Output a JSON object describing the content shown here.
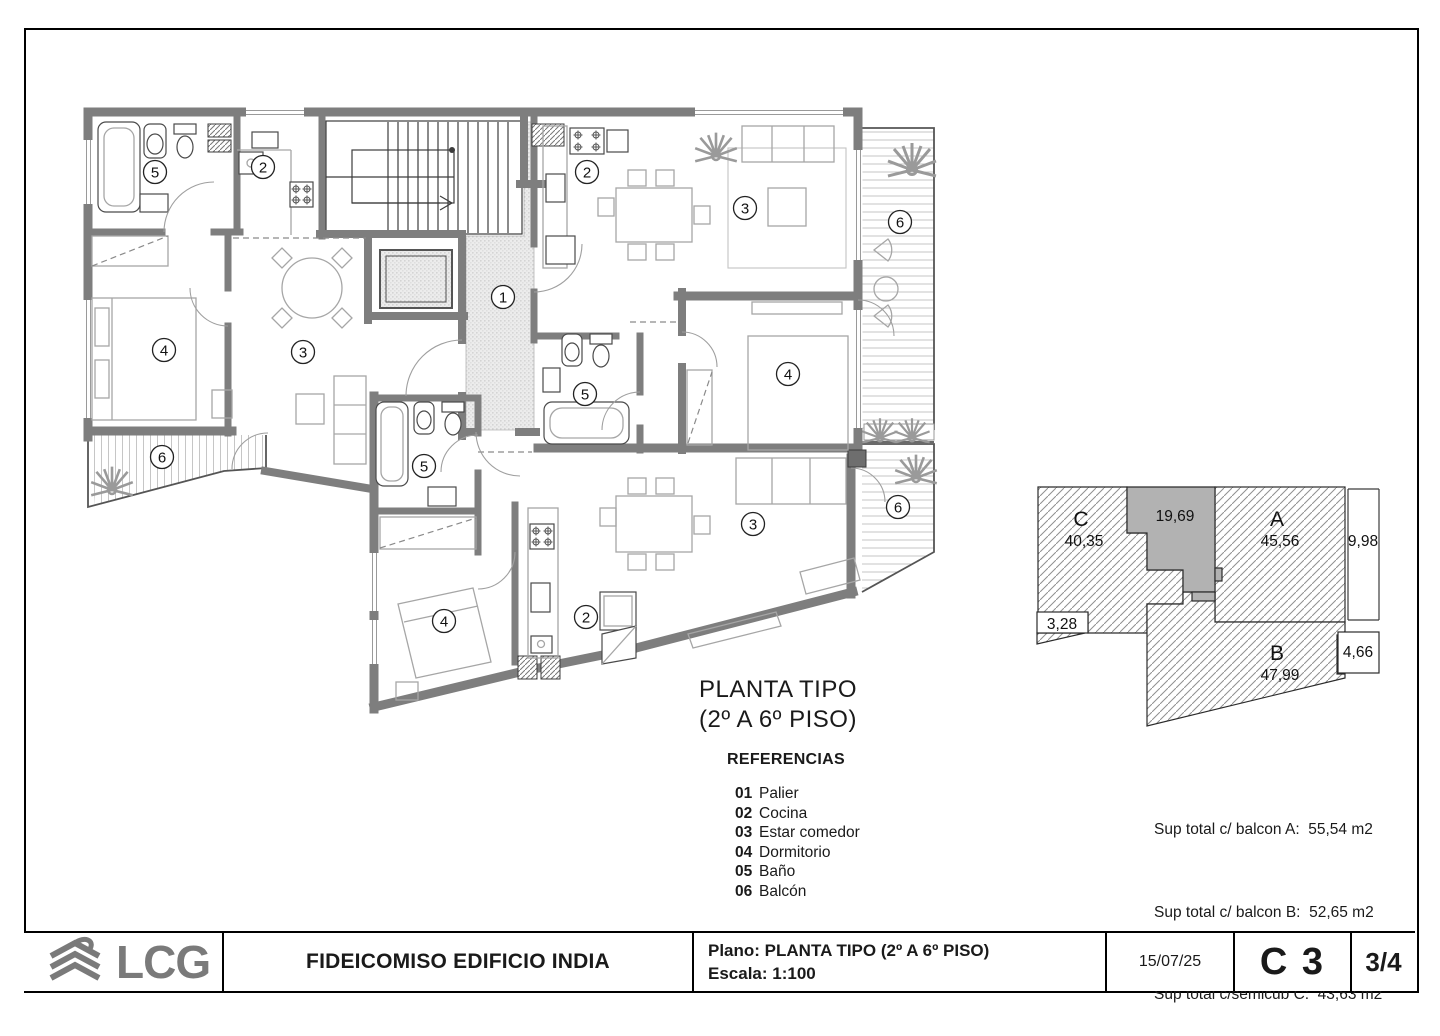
{
  "doc": {
    "title_line1": "PLANTA TIPO",
    "title_line2": "(2º A 6º PISO)",
    "references": {
      "heading": "REFERENCIAS",
      "items": [
        {
          "num": "01",
          "label": "Palier"
        },
        {
          "num": "02",
          "label": "Cocina"
        },
        {
          "num": "03",
          "label": "Estar comedor"
        },
        {
          "num": "04",
          "label": "Dormitorio"
        },
        {
          "num": "05",
          "label": "Baño"
        },
        {
          "num": "06",
          "label": "Balcón"
        }
      ]
    },
    "areas": [
      "Sup total c/ balcon A:  55,54 m2",
      "Sup total c/ balcon B:  52,65 m2",
      "Sup total c/semicub C:  43,63 m2"
    ],
    "key": {
      "c_letter": "C",
      "c_area": "40,35",
      "core_area": "19,69",
      "a_letter": "A",
      "a_area": "45,56",
      "b_letter": "B",
      "b_area": "47,99",
      "dim_width": "9,98",
      "dim_left": "3,28",
      "dim_right": "4,66"
    },
    "plan": {
      "labels": [
        "5",
        "2",
        "2",
        "3",
        "6",
        "1",
        "4",
        "3",
        "4",
        "5",
        "6",
        "5",
        "6",
        "3",
        "2",
        "4"
      ]
    },
    "title_block": {
      "company": "LCG",
      "project": "FIDEICOMISO EDIFICIO INDIA",
      "plano": "Plano: PLANTA TIPO (2º A 6º PISO)",
      "escala": "Escala: 1:100",
      "date": "15/07/25",
      "code": "C 3",
      "sheet": "3/4"
    },
    "colors": {
      "wall": "#7e7e7e",
      "core_fill": "#b2b2b2",
      "logo_gray": "#7a7a7a"
    }
  }
}
